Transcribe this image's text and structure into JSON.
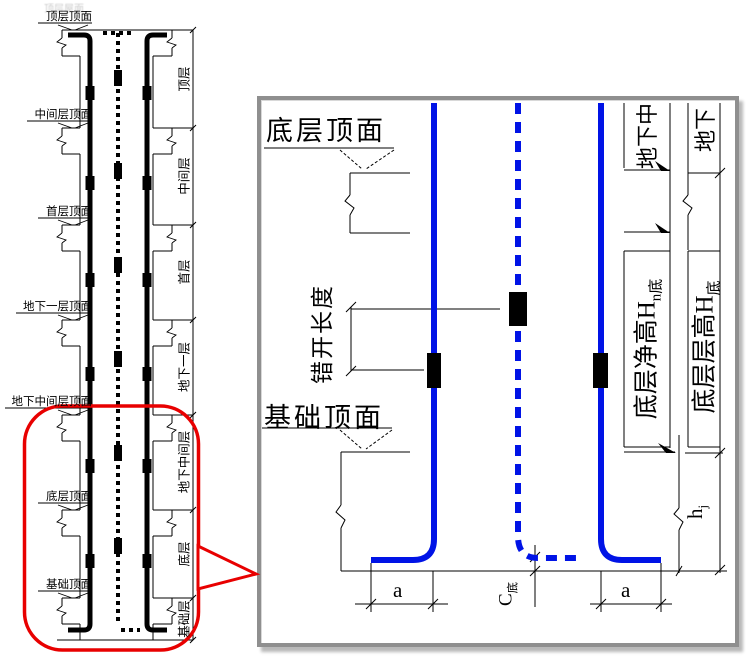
{
  "colors": {
    "rebar_blue": "#0013e6",
    "callout_red": "#e80000",
    "line_black": "#000000"
  },
  "overview": {
    "ghost_label": "顶层屋面",
    "leader_labels": [
      {
        "text": "顶层顶面"
      },
      {
        "text": "中间层顶面"
      },
      {
        "text": "首层顶面"
      },
      {
        "text": "地下一层顶面"
      },
      {
        "text": "地下中间层顶面"
      },
      {
        "text": "底层顶面"
      },
      {
        "text": "基础顶面"
      }
    ],
    "floor_labels": [
      {
        "text": "顶层"
      },
      {
        "text": "中间层"
      },
      {
        "text": "首层"
      },
      {
        "text": "地下一层"
      },
      {
        "text": "地下中间层"
      },
      {
        "text": "底层"
      },
      {
        "text": "基础层"
      }
    ]
  },
  "detail": {
    "top_surface_label": "底层顶面",
    "foundation_surface_label": "基础顶面",
    "stagger_label": "错开长度",
    "upper_floor_labels": [
      {
        "text": "地下中"
      },
      {
        "text": "地下"
      }
    ],
    "clear_height": {
      "text": "底层净高H",
      "sub": "n底"
    },
    "story_height": {
      "text": "底层层高H",
      "sub": "底"
    },
    "foundation_height": {
      "text": "h",
      "sub": "j"
    },
    "c_base": {
      "text": "C",
      "sub": "底"
    },
    "dim_a_left": "a",
    "dim_a_right": "a"
  }
}
